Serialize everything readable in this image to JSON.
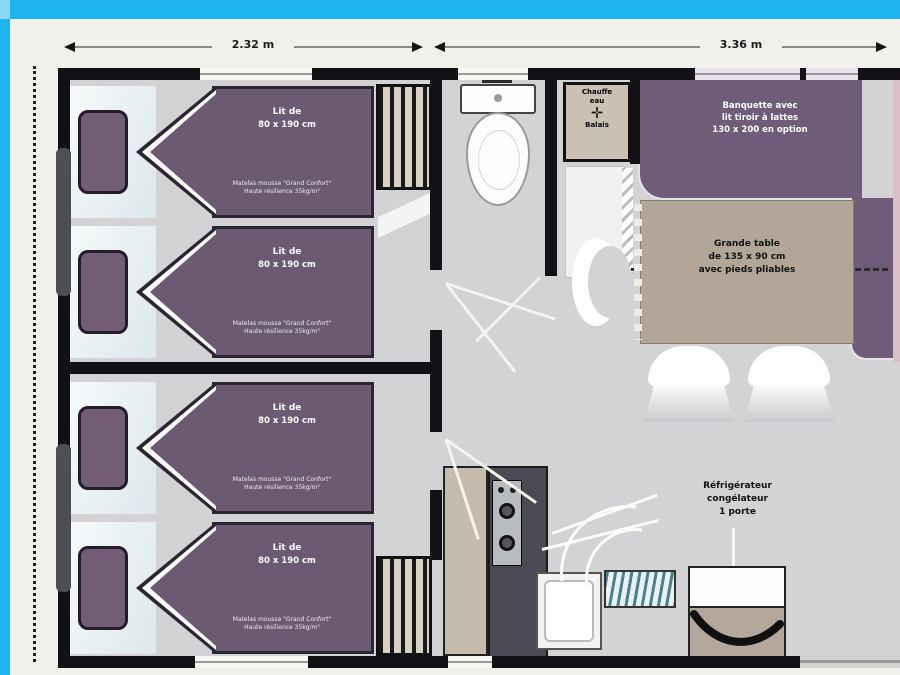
{
  "plan": {
    "dimensions": {
      "width_left": "2.32 m",
      "width_right": "3.36 m"
    },
    "beds": [
      {
        "title": "Lit de",
        "size": "80 x 190 cm",
        "mattress1": "Matelas mousse \"Grand Confort\"",
        "mattress2": "Haute résilience 35kg/m³"
      },
      {
        "title": "Lit de",
        "size": "80 x 190 cm",
        "mattress1": "Matelas mousse \"Grand Confort\"",
        "mattress2": "Haute résilience 35kg/m³"
      },
      {
        "title": "Lit de",
        "size": "80 x 190 cm",
        "mattress1": "Matelas mousse \"Grand Confort\"",
        "mattress2": "Haute résilience 35kg/m³"
      },
      {
        "title": "Lit de",
        "size": "80 x 190 cm",
        "mattress1": "Matelas mousse \"Grand Confort\"",
        "mattress2": "Haute résilience 35kg/m³"
      }
    ],
    "utility_closet": {
      "line1": "Chauffe",
      "line2": "eau",
      "line3": "Balais",
      "icon": "valve-cross"
    },
    "banquette": {
      "line1": "Banquette avec",
      "line2": "lit tiroir à lattes",
      "line3": "130 x 200 en option"
    },
    "table": {
      "line1": "Grande table",
      "line2": "de 135 x 90 cm",
      "line3": "avec pieds pliables"
    },
    "fridge": {
      "line1": "Réfrigérateur",
      "line2": "congélateur",
      "line3": "1 porte"
    }
  },
  "colors": {
    "frame_cyan": "#1db4f0",
    "bed_purple": "#6b5a72",
    "banquette_purple": "#6f5c78",
    "table_taupe": "#b1a698",
    "floor_gray": "#d3d3d6",
    "wall_black": "#121116"
  }
}
